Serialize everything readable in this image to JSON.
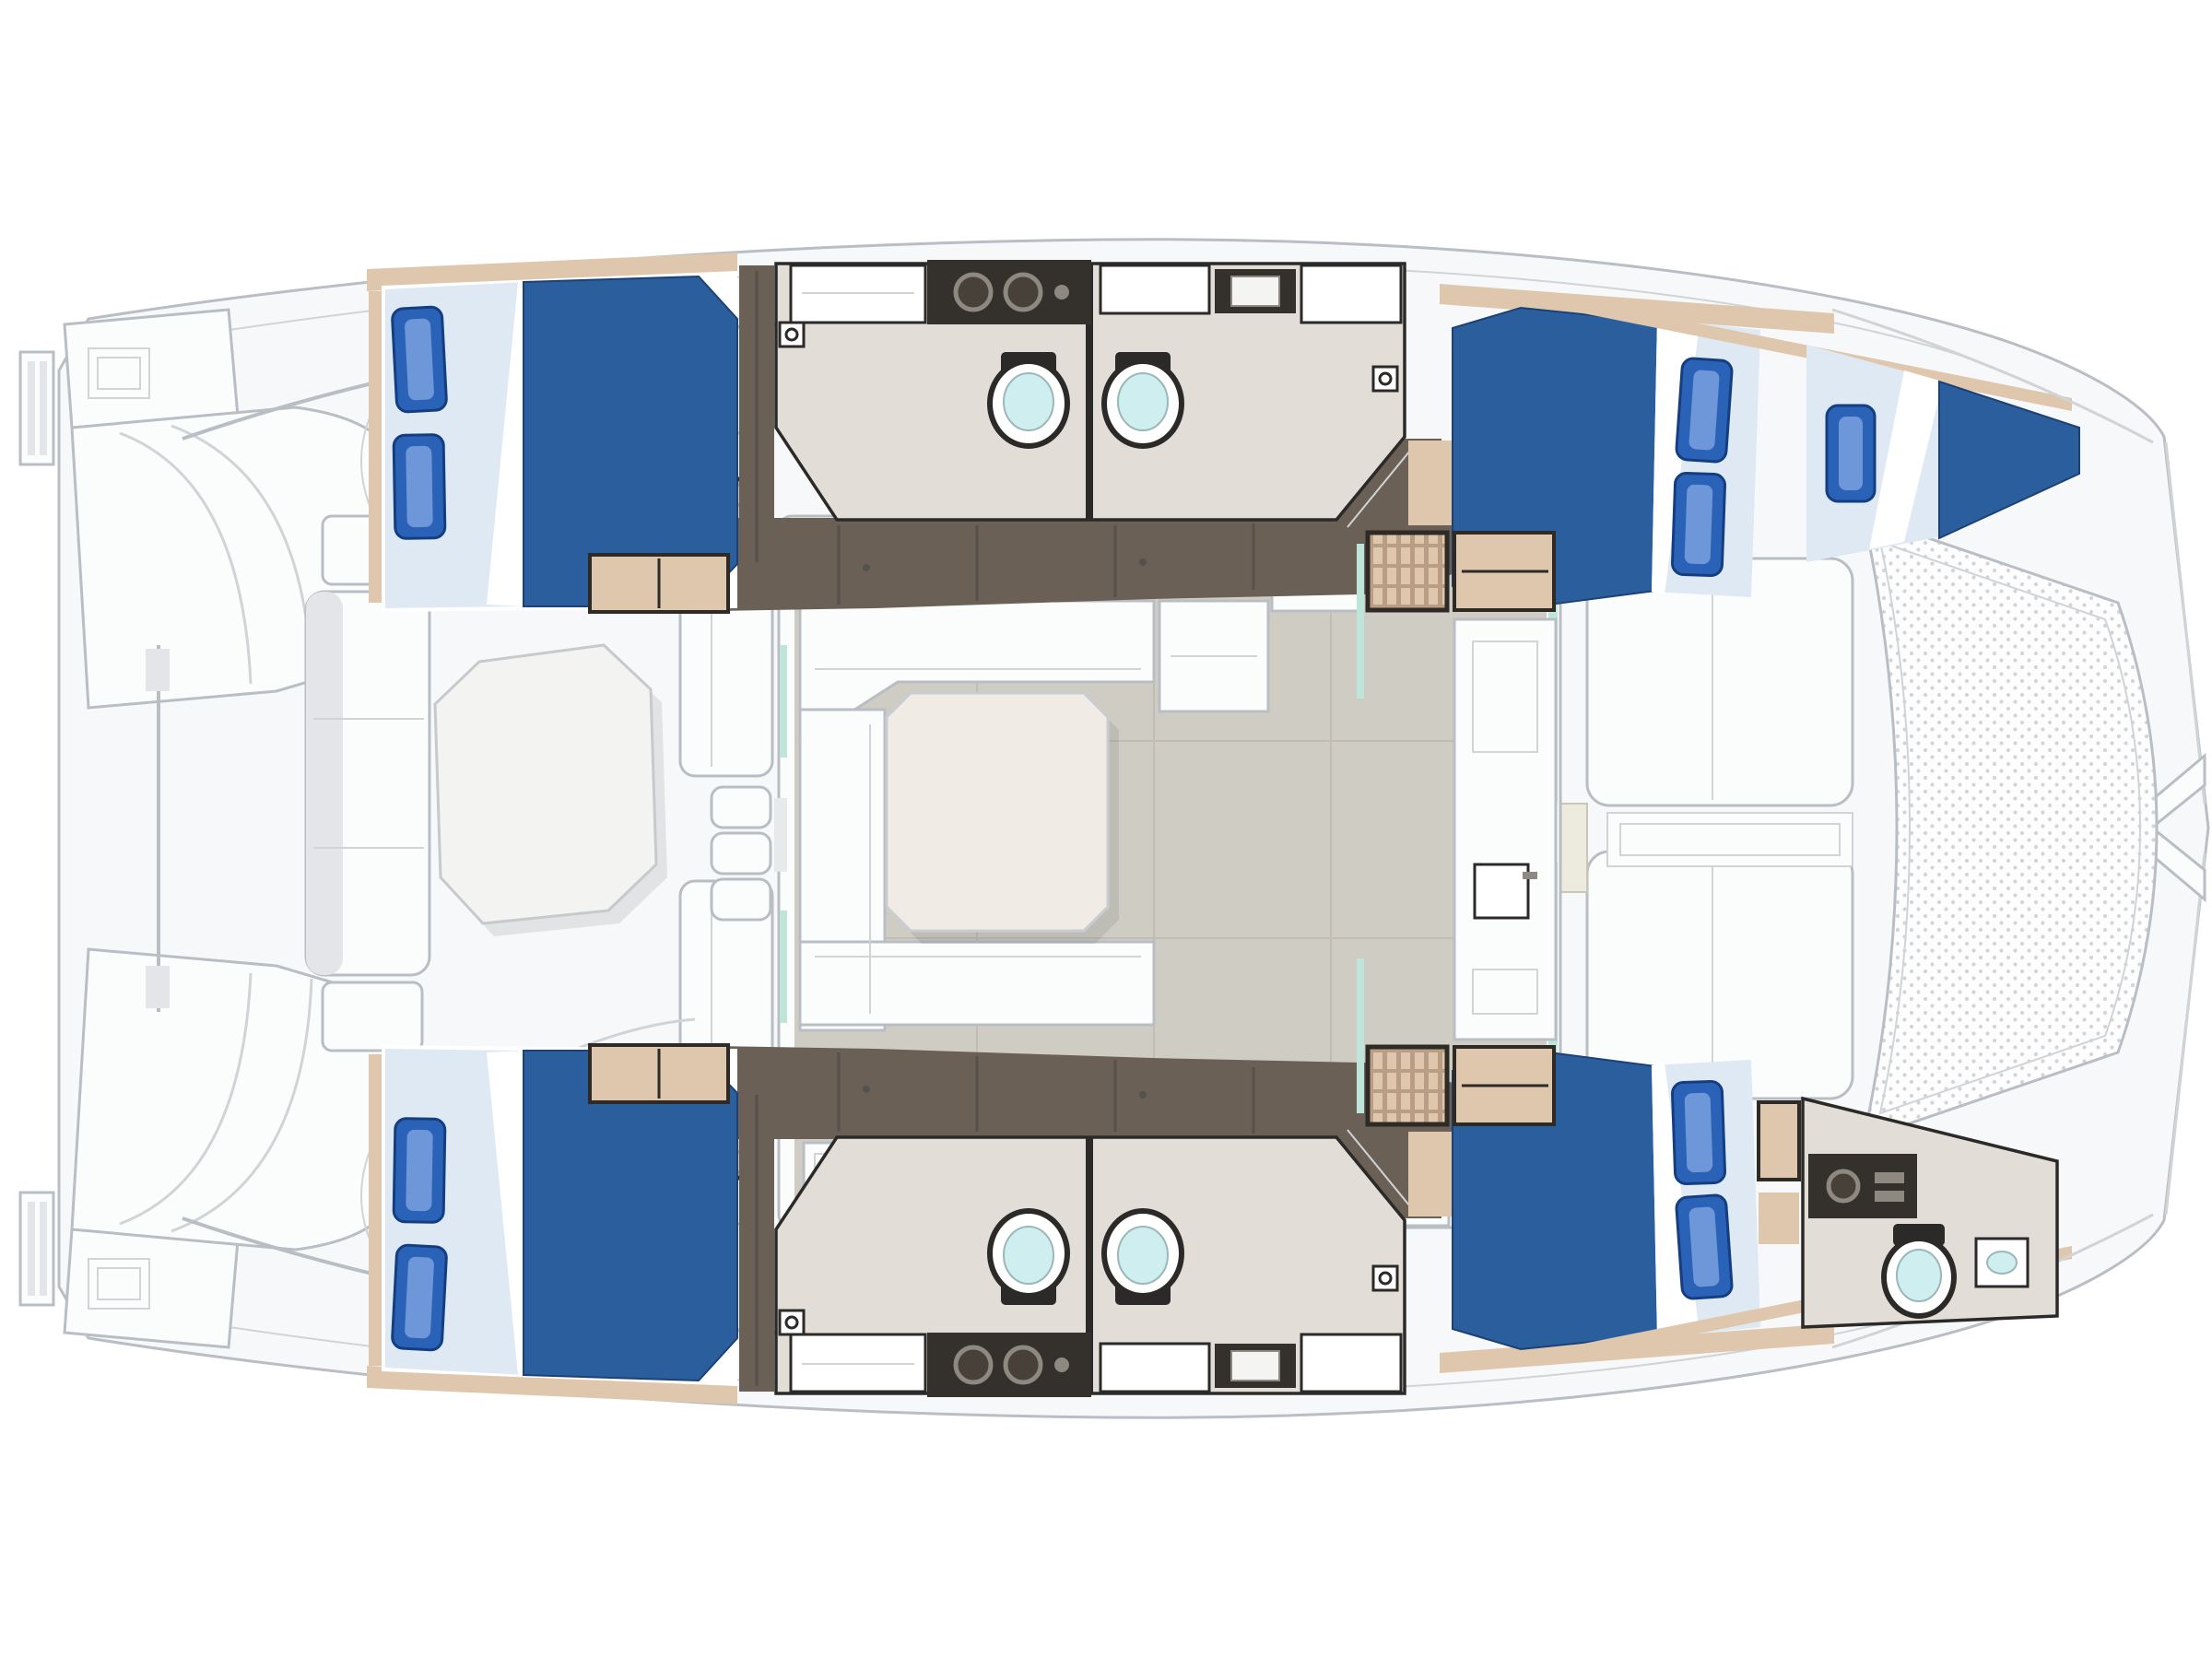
{
  "page": {
    "title": "Catamaran deck and accommodation floor plan",
    "orientation": "bow-right",
    "view": "overhead-plan"
  },
  "colors": {
    "background": "#ffffff",
    "deck": "#f7f8f9",
    "outline": "#b9bec4",
    "outline_soft": "#d0d4d7",
    "panel_white": "#fbfcfc",
    "panel_shadow": "#e3e5e8",
    "dark_line": "#2b2a28",
    "hull_floor": "#6a6055",
    "hull_floor_seam": "#57514b",
    "bath_floor": "#e2ded7",
    "salon_floor": "#cfccc3",
    "salon_floor_seam": "#c1bdb4",
    "wood": "#dfc7ae",
    "wood_deep": "#b99e84",
    "wood_frame": "#2e2a26",
    "bed_blue": "#2b5e9d",
    "bed_blue_edge": "#1c4176",
    "sheet": "#dfe9f3",
    "pillow": "#2a62b8",
    "pillow_hi": "#6d97d8",
    "pillow_edge": "#143e80",
    "toilet_cyan": "#cfeef0",
    "glass_mint": "#bfe4da",
    "counter_dark": "#34302b",
    "basin_ring": "#8d8880",
    "stove_dark": "#2f2b27",
    "mesh_dot": "#d2d5d8",
    "table_top": "#f0ebe5",
    "cockpit_table": "#f3f4f2",
    "ivory": "#edebdd"
  },
  "rooms": [
    {
      "id": "cockpit",
      "name": "Aft cockpit with table and benches"
    },
    {
      "id": "salon",
      "name": "Salon with U-shaped dinette and aft galley"
    },
    {
      "id": "port-aft-cabin",
      "name": "Port aft double cabin"
    },
    {
      "id": "port-heads",
      "name": "Port twin bathrooms amidships"
    },
    {
      "id": "port-forward-cabin",
      "name": "Port forward double cabin"
    },
    {
      "id": "port-forepeak-berth",
      "name": "Port bow crew berth"
    },
    {
      "id": "starboard-aft-cabin",
      "name": "Starboard aft double cabin"
    },
    {
      "id": "starboard-heads",
      "name": "Starboard twin bathrooms amidships"
    },
    {
      "id": "starboard-forward-cabin",
      "name": "Starboard forward double cabin"
    },
    {
      "id": "starboard-bow-head",
      "name": "Starboard bow crew head"
    },
    {
      "id": "foredeck",
      "name": "Foredeck lounge pads"
    },
    {
      "id": "trampoline",
      "name": "Bow trampoline net"
    },
    {
      "id": "transom-steps",
      "name": "Twin transom swim steps"
    }
  ],
  "fixtures": {
    "double_berths": 4,
    "single_berths": 1,
    "toilets": 5,
    "vanity_basins": 5,
    "stove_burners": 3,
    "tables": 2,
    "companionway_stairs": 4
  }
}
